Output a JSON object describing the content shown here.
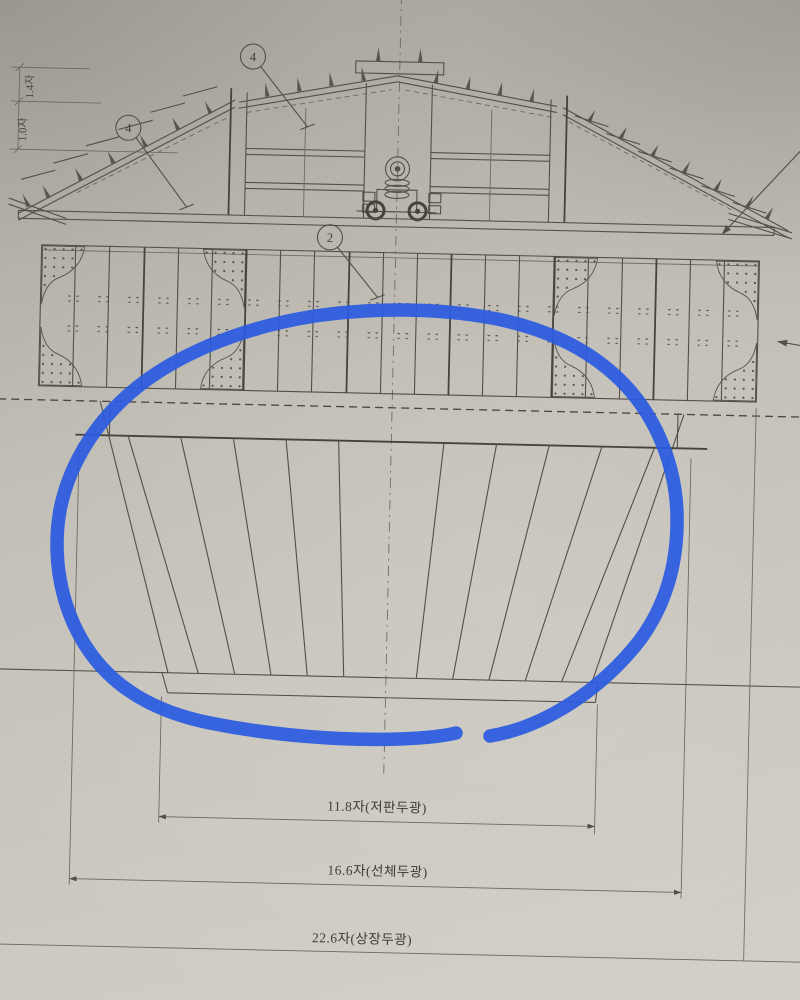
{
  "drawing": {
    "description_labels": {
      "width_dims": {
        "bottom_plank": "11.8자(저판두광)",
        "hull": "16.6자(선체두광)",
        "upper_structure": "22.6자(상장두광)"
      },
      "height_dims": {
        "upper": "1.4자",
        "lower": "1.0자"
      },
      "callouts": {
        "roof_top": "4",
        "roof_left": "4",
        "upper_band": "2"
      }
    },
    "colors": {
      "ink": "#534f48",
      "paper": "#c1beb6",
      "annotation_blue": "#2b5be0"
    },
    "annotation": {
      "shape": "hand-drawn ellipse",
      "region": "lower hull plank fan"
    }
  }
}
